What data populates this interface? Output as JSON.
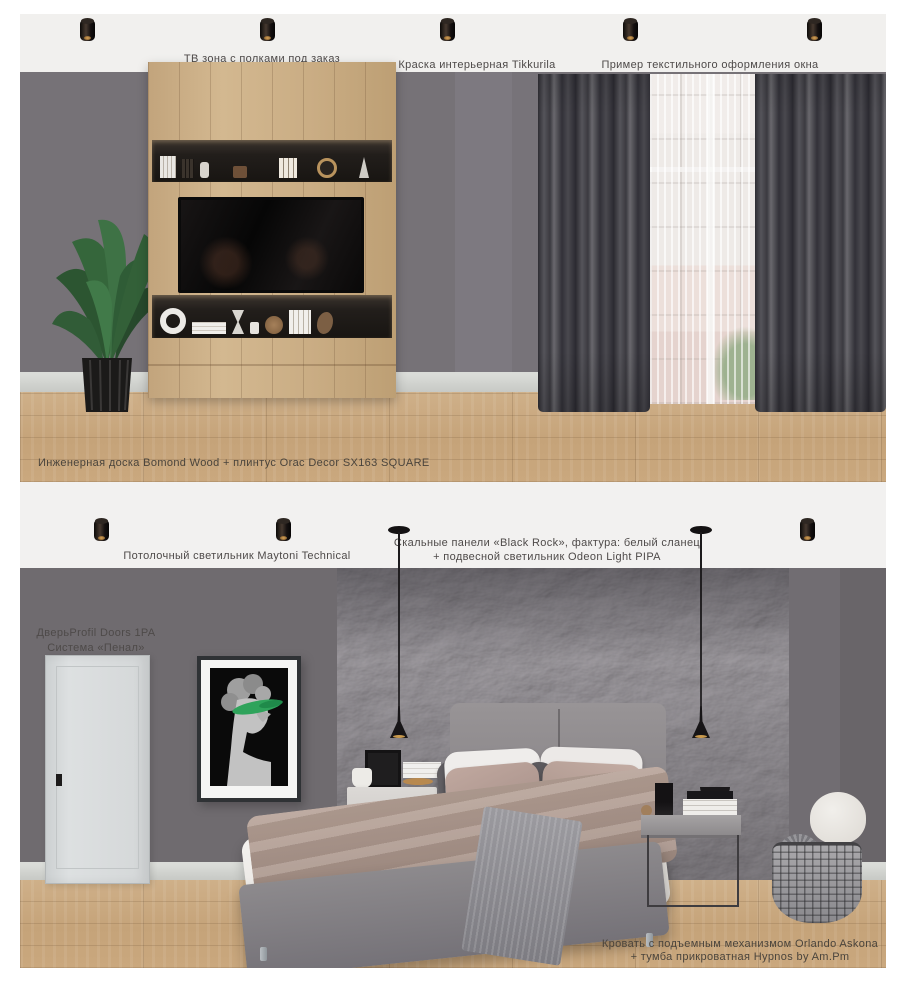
{
  "panel_top": {
    "label_tv_zone": "ТВ зона с полками под заказ",
    "label_paint": "Краска интерьерная Tikkurila",
    "label_textile": "Пример текстильного оформления окна",
    "label_floor": "Инженерная доска Bomond Wood + плинтус Orac Decor SX163 SQUARE"
  },
  "panel_bottom": {
    "label_ceiling_light": "Потолочный светильник Maytoni Technical",
    "label_rock_line1": "Скальные панели «Black Rock», фактура: белый сланец",
    "label_rock_line2": "+ подвесной светильник Odeon Light PIPA",
    "label_door_line1": "ДверьProfil Doors 1PA",
    "label_door_line2": "Система «Пенал»",
    "label_bed_line1": "Кровать с подъемным механизмом Orlando Askona",
    "label_bed_line2": "+ тумба прикроватная Hypnos by Am.Pm"
  },
  "colors": {
    "wall_top": "#767277",
    "wall_bottom": "#6f6b6f",
    "ceiling": "#f1f0ee",
    "floor_wood": "#c9a87e",
    "curtain": "#45444a",
    "rock_panel": "#57545a",
    "door": "#d6d9da",
    "accent_green": "#2fa35b",
    "bed_upholstery": "#8a878b",
    "pillow_taupe": "#b49c93"
  }
}
